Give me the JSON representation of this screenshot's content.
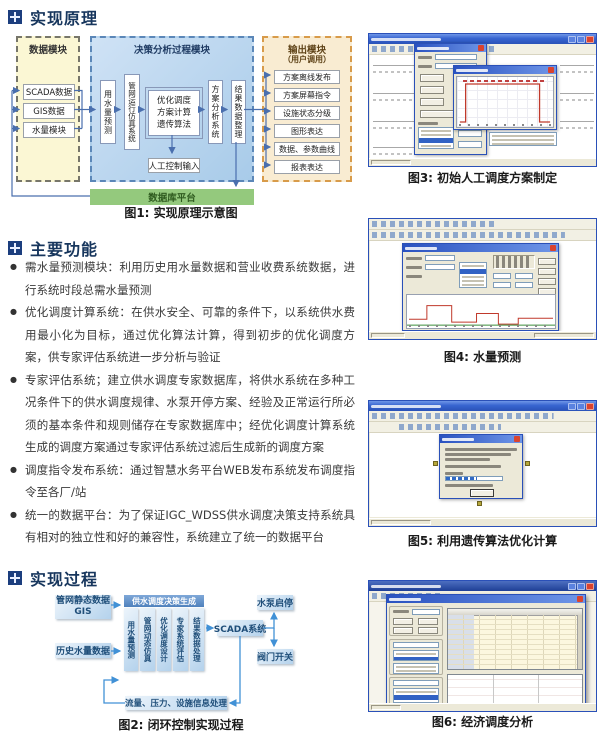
{
  "sections": {
    "principle": "实现原理",
    "functions": "主要功能",
    "process": "实现过程"
  },
  "diagram1": {
    "caption": "图1: 实现原理示意图",
    "data_module": {
      "title": "数据模块",
      "items": [
        "SCADA数据",
        "GIS数据",
        "水量模块"
      ]
    },
    "decision_module": {
      "title": "决策分析过程模块",
      "forecast": "用水量预测",
      "simulation": "管网运行仿真系统",
      "core_lines": [
        "优化调度",
        "方案计算",
        "遗传算法"
      ],
      "manual_input": "人工控制输入",
      "analysis": "方案分析系统",
      "result": "结果数据整理"
    },
    "output_module": {
      "title": "输出模块",
      "subtitle": "（用户调用）",
      "items": [
        "方案离线发布",
        "方案屏幕指令",
        "设施状态分级",
        "图形表达",
        "数据、参数曲线",
        "报表表达"
      ]
    },
    "platform": "数据库平台"
  },
  "functions_list": [
    "需水量预测模块：利用历史用水量数据和营业收费系统数据，进行系统时段总需水量预测",
    "优化调度计算系统：在供水安全、可靠的条件下，以系统供水费用最小化为目标，通过优化算法计算，得到初步的优化调度方案，供专家评估系统进一步分析与验证",
    "专家评估系统；建立供水调度专家数据库，将供水系统在多种工况条件下的供水调度规律、水泵开停方案、经验及正常运行所必须的基本条件和规则储存在专家数据库中；经优化调度计算系统生成的调度方案通过专家评估系统过滤后生成新的调度方案",
    "调度指令发布系统：通过智慧水务平台WEB发布系统发布调度指令至各厂/站",
    "统一的数据平台：为了保证IGC_WDSS供水调度决策支持系统具有相对的独立性和好的兼容性，系统建立了统一的数据平台"
  ],
  "diagram2": {
    "caption": "图2: 闭环控制实现过程",
    "gis_line1": "管网静态数据",
    "gis_line2": "GIS",
    "history": "历史水量数据",
    "header": "供水调度决策生成",
    "columns": [
      "用水量预测",
      "管网动态仿真",
      "优化调度设计",
      "专家系统评估",
      "结果数据处理"
    ],
    "scada": "SCADA系统",
    "pump": "水泵启停",
    "valve": "阀门开关",
    "feedback": "流量、压力、设施信息处理"
  },
  "figures": [
    {
      "caption": "图3: 初始人工调度方案制定"
    },
    {
      "caption": "图4: 水量预测"
    },
    {
      "caption": "图5: 利用遗传算法优化计算"
    },
    {
      "caption": "图6: 经济调度分析"
    }
  ],
  "colors": {
    "accent_navy": "#17365d",
    "platform_green": "#94c97d",
    "xp_title_blue": "#2a52b8",
    "chart_red": "#c0392b"
  }
}
